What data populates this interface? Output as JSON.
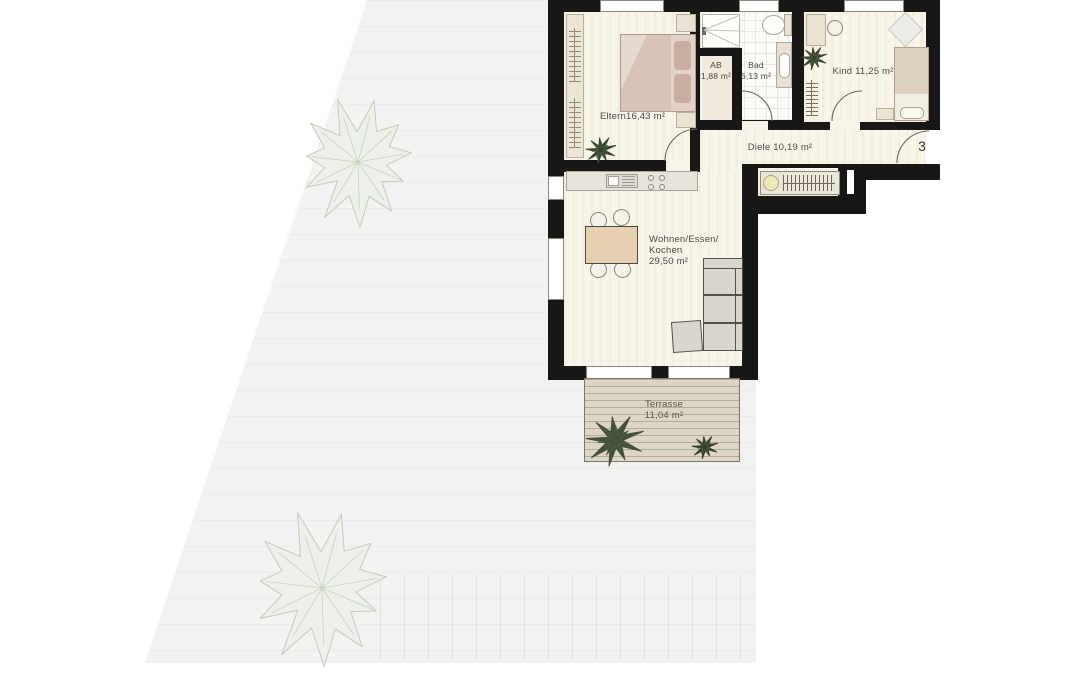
{
  "plan": {
    "unit_number": "3",
    "rooms": {
      "eltern": {
        "name": "Eltern",
        "area": "16,43 m²"
      },
      "ab": {
        "name": "AB",
        "area": "1,88 m²"
      },
      "bad": {
        "name": "Bad",
        "area": "6,13 m²"
      },
      "kind": {
        "name": "Kind",
        "area": "11,25 m²"
      },
      "diele": {
        "name": "Diele",
        "area": "10,19 m²"
      },
      "wohnen": {
        "name_line1": "Wohnen/Essen/",
        "name_line2": "Kochen",
        "area": "29,50 m²"
      },
      "terrasse": {
        "name": "Terrasse",
        "area": "11,04 m²"
      }
    },
    "colors": {
      "wall": "#181715",
      "room_floor": "#f8f4ea",
      "bath_floor": "#fbfbf7",
      "garden": "#f2f2f0",
      "terrace_deck": "#ddd6c6",
      "tree": "#edf0e9",
      "indoor_plant": "#3c4832",
      "bed": "#d9c5ba",
      "label_text": "#4f4a43"
    }
  }
}
